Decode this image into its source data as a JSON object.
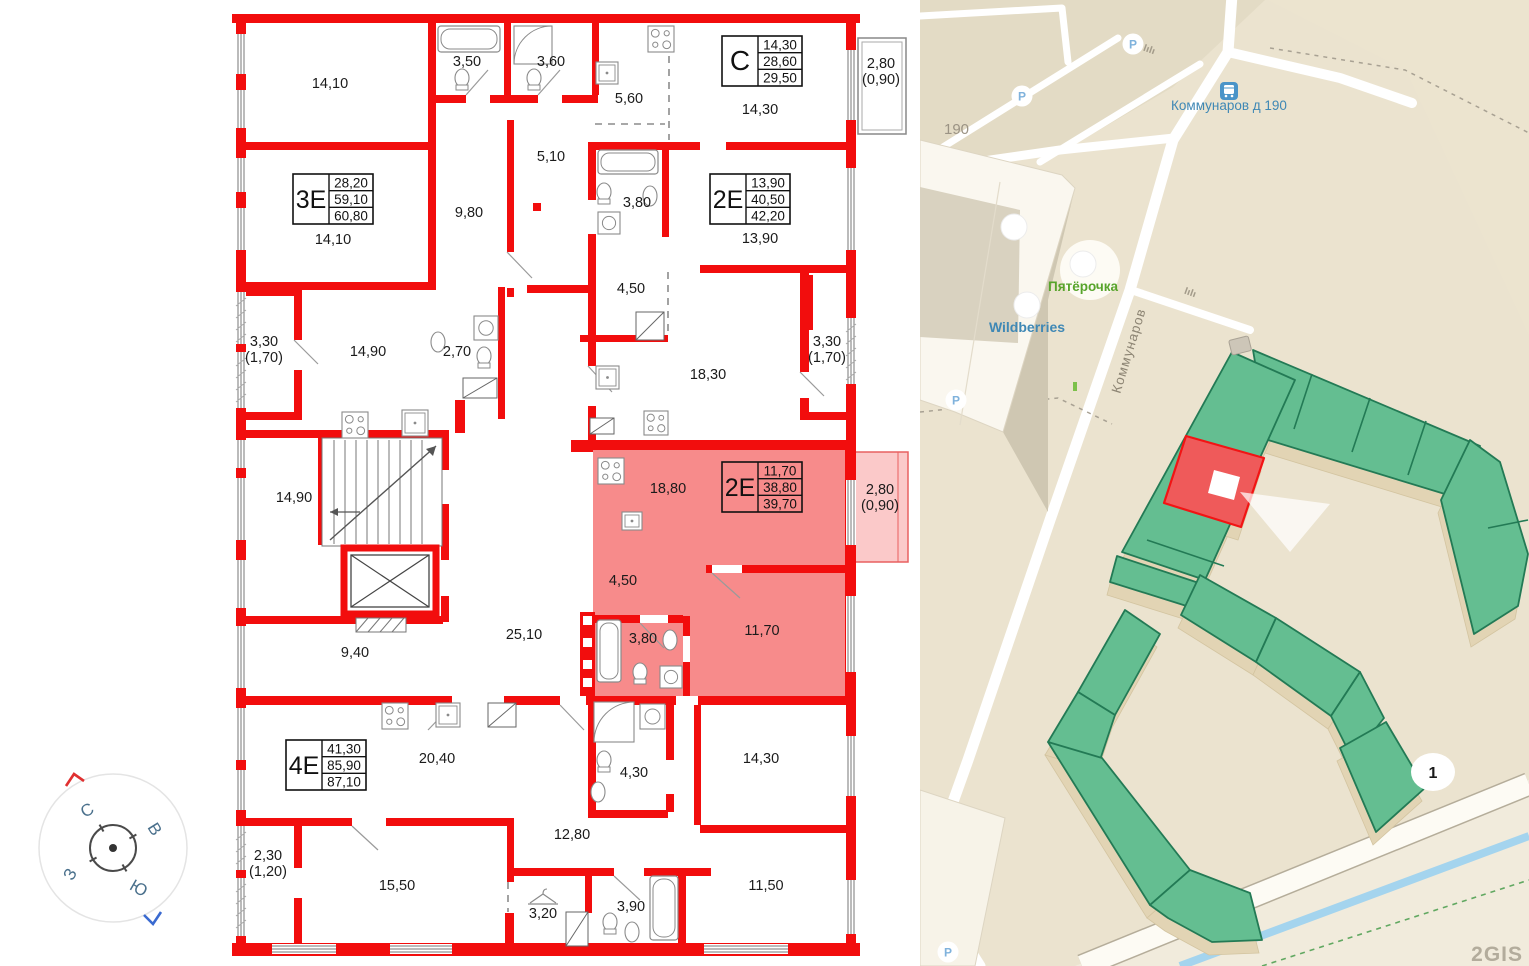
{
  "floorplan": {
    "wall_color": "#f20d0d",
    "highlight_fill": "#f78b8b",
    "highlight_balcony_fill": "#fbc9c9",
    "apartment_tables": [
      {
        "label": "С",
        "values": [
          "14,30",
          "28,60",
          "29,50"
        ],
        "x": 722,
        "y": 36,
        "highlighted": false
      },
      {
        "label": "3Е",
        "values": [
          "28,20",
          "59,10",
          "60,80"
        ],
        "x": 293,
        "y": 174,
        "highlighted": false
      },
      {
        "label": "2Е",
        "values": [
          "13,90",
          "40,50",
          "42,20"
        ],
        "x": 710,
        "y": 174,
        "highlighted": false
      },
      {
        "label": "2Е",
        "values": [
          "11,70",
          "38,80",
          "39,70"
        ],
        "x": 722,
        "y": 462,
        "highlighted": true
      },
      {
        "label": "4Е",
        "values": [
          "41,30",
          "85,90",
          "87,10"
        ],
        "x": 286,
        "y": 740,
        "highlighted": false
      }
    ],
    "room_labels": [
      {
        "lines": [
          "14,10"
        ],
        "x": 330,
        "y": 88
      },
      {
        "lines": [
          "3,50"
        ],
        "x": 467,
        "y": 66
      },
      {
        "lines": [
          "3,60"
        ],
        "x": 551,
        "y": 66
      },
      {
        "lines": [
          "5,60"
        ],
        "x": 629,
        "y": 103
      },
      {
        "lines": [
          "14,30"
        ],
        "x": 760,
        "y": 114
      },
      {
        "lines": [
          "2,80",
          "(0,90)"
        ],
        "x": 881,
        "y": 68
      },
      {
        "lines": [
          "14,10"
        ],
        "x": 333,
        "y": 244
      },
      {
        "lines": [
          "9,80"
        ],
        "x": 469,
        "y": 217
      },
      {
        "lines": [
          "5,10"
        ],
        "x": 551,
        "y": 161
      },
      {
        "lines": [
          "3,80"
        ],
        "x": 637,
        "y": 207
      },
      {
        "lines": [
          "13,90"
        ],
        "x": 760,
        "y": 243
      },
      {
        "lines": [
          "4,50"
        ],
        "x": 631,
        "y": 293
      },
      {
        "lines": [
          "3,30",
          "(1,70)"
        ],
        "x": 264,
        "y": 346
      },
      {
        "lines": [
          "14,90"
        ],
        "x": 368,
        "y": 356
      },
      {
        "lines": [
          "2,70"
        ],
        "x": 457,
        "y": 356
      },
      {
        "lines": [
          "18,30"
        ],
        "x": 708,
        "y": 379
      },
      {
        "lines": [
          "3,30",
          "(1,70)"
        ],
        "x": 827,
        "y": 346
      },
      {
        "lines": [
          "14,90"
        ],
        "x": 294,
        "y": 502
      },
      {
        "lines": [
          "18,80"
        ],
        "x": 668,
        "y": 493
      },
      {
        "lines": [
          "2,80",
          "(0,90)"
        ],
        "x": 880,
        "y": 494
      },
      {
        "lines": [
          "4,50"
        ],
        "x": 623,
        "y": 585
      },
      {
        "lines": [
          "25,10"
        ],
        "x": 524,
        "y": 639
      },
      {
        "lines": [
          "3,80"
        ],
        "x": 643,
        "y": 643
      },
      {
        "lines": [
          "11,70"
        ],
        "x": 762,
        "y": 635
      },
      {
        "lines": [
          "9,40"
        ],
        "x": 355,
        "y": 657
      },
      {
        "lines": [
          "20,40"
        ],
        "x": 437,
        "y": 763
      },
      {
        "lines": [
          "4,30"
        ],
        "x": 634,
        "y": 777
      },
      {
        "lines": [
          "14,30"
        ],
        "x": 761,
        "y": 763
      },
      {
        "lines": [
          "12,80"
        ],
        "x": 572,
        "y": 839
      },
      {
        "lines": [
          "2,30",
          "(1,20)"
        ],
        "x": 268,
        "y": 860
      },
      {
        "lines": [
          "15,50"
        ],
        "x": 397,
        "y": 890
      },
      {
        "lines": [
          "3,20"
        ],
        "x": 543,
        "y": 918
      },
      {
        "lines": [
          "3,90"
        ],
        "x": 631,
        "y": 911
      },
      {
        "lines": [
          "11,50"
        ],
        "x": 766,
        "y": 890
      }
    ]
  },
  "compass": {
    "letters": [
      {
        "t": "С",
        "x": 90,
        "y": 815,
        "rot": -30
      },
      {
        "t": "В",
        "x": 150,
        "y": 832,
        "rot": 58
      },
      {
        "t": "З",
        "x": 75,
        "y": 877,
        "rot": -60
      },
      {
        "t": "Ю",
        "x": 136,
        "y": 893,
        "rot": 30
      }
    ]
  },
  "map": {
    "labels": {
      "block": "190",
      "stop": "Коммунаров д 190",
      "street": "Коммунаров",
      "pyaterochka": "Пятёрочка",
      "wildberries": "Wildberries",
      "marker": "1",
      "watermark": "2GIS",
      "parking": "Р"
    },
    "colors": {
      "bg": "#ebe3cf",
      "parking_zone": "#e3dbc5",
      "block_zone": "#ece4cf",
      "building_green": "#64be91",
      "building_green_stroke": "#237a55",
      "extrusion": "#e2d4b4",
      "highlight_red": "#ef5a5a",
      "highlight_red_stroke": "#f21414",
      "road": "#ffffff",
      "water": "#a4d4ee",
      "label_blue": "#3f88b5",
      "label_green": "#58a42c",
      "label_gray": "#9b9384",
      "street_gray": "#8d8574",
      "watermark_gray": "#b3ac9c",
      "wb_purple": "#7a5fd0",
      "rest_orange": "#e8862e"
    }
  }
}
